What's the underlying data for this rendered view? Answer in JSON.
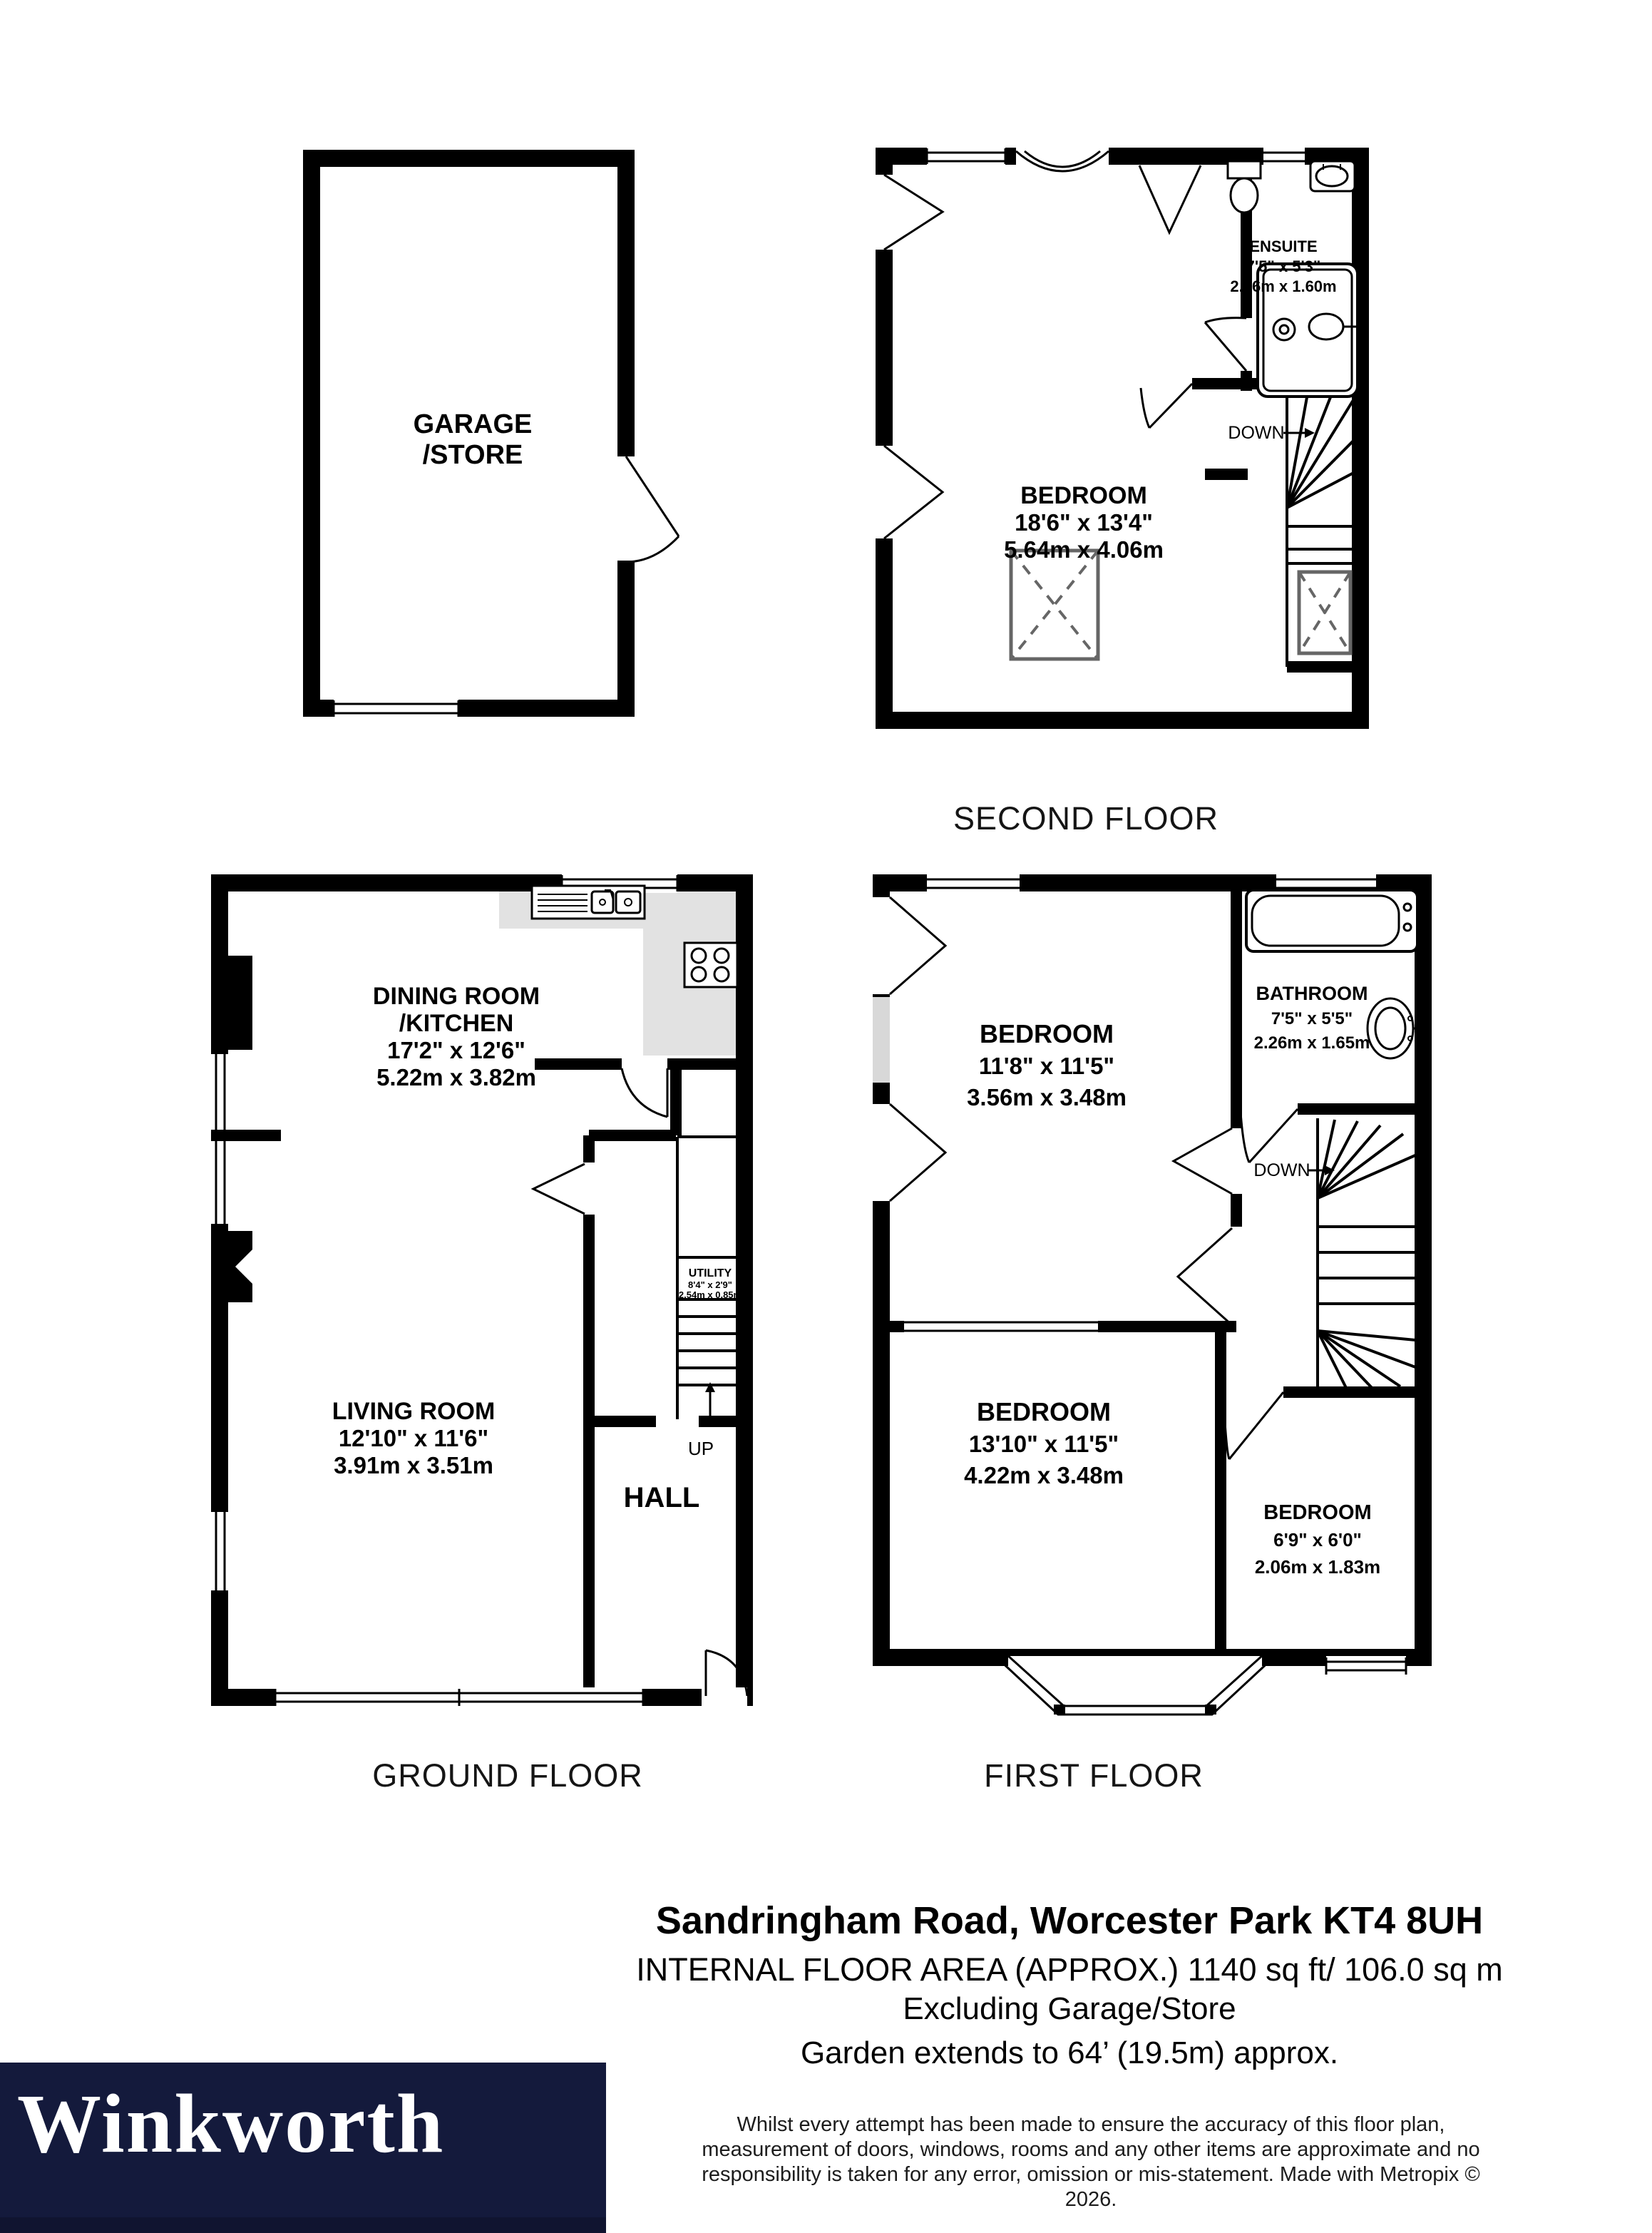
{
  "plans": {
    "garage": {
      "name_line1": "GARAGE",
      "name_line2": "/STORE"
    },
    "second_floor": {
      "caption": "SECOND FLOOR",
      "bedroom": {
        "name": "BEDROOM",
        "imperial": "18'6\" x 13'4\"",
        "metric": "5.64m x 4.06m"
      },
      "ensuite": {
        "name": "ENSUITE",
        "imperial": "7'5\" x 5'3\"",
        "metric": "2.26m x 1.60m"
      },
      "stair_label": "DOWN"
    },
    "ground_floor": {
      "caption": "GROUND FLOOR",
      "dining_kitchen": {
        "name_line1": "DINING ROOM",
        "name_line2": "/KITCHEN",
        "imperial": "17'2\" x 12'6\"",
        "metric": "5.22m x 3.82m"
      },
      "living": {
        "name": "LIVING ROOM",
        "imperial": "12'10\" x 11'6\"",
        "metric": "3.91m x 3.51m"
      },
      "utility": {
        "name": "UTILITY",
        "imperial": "8'4\" x 2'9\"",
        "metric": "2.54m x 0.85m"
      },
      "hall": {
        "name": "HALL"
      },
      "stair_label": "UP"
    },
    "first_floor": {
      "caption": "FIRST FLOOR",
      "bedroom_back": {
        "name": "BEDROOM",
        "imperial": "11'8\" x 11'5\"",
        "metric": "3.56m x 3.48m"
      },
      "bathroom": {
        "name": "BATHROOM",
        "imperial": "7'5\" x 5'5\"",
        "metric": "2.26m x 1.65m"
      },
      "bedroom_front": {
        "name": "BEDROOM",
        "imperial": "13'10\" x 11'5\"",
        "metric": "4.22m x 3.48m"
      },
      "bedroom_small": {
        "name": "BEDROOM",
        "imperial": "6'9\" x 6'0\"",
        "metric": "2.06m x 1.83m"
      },
      "stair_label": "DOWN"
    }
  },
  "footer": {
    "address": "Sandringham Road, Worcester Park KT4 8UH",
    "area": "INTERNAL FLOOR AREA (APPROX.) 1140 sq ft/ 106.0 sq m",
    "excluding": "Excluding Garage/Store",
    "garden": "Garden extends to 64’ (19.5m) approx.",
    "disclaimer_line1": "Whilst every attempt has been made to ensure the accuracy of this floor plan,",
    "disclaimer_line2": "measurement of doors, windows, rooms and any other items are approximate and no",
    "disclaimer_line3": "responsibility is taken for any error, omission or mis-statement. Made with Metropix © 2026."
  },
  "logo": {
    "brand": "Winkworth",
    "background": "#141A3C"
  },
  "colors": {
    "wall": "#000000",
    "kitchen_counter": "#e2e2e2",
    "wardrobe_gray": "#d8d8d8",
    "skylight_stroke": "#666666"
  }
}
